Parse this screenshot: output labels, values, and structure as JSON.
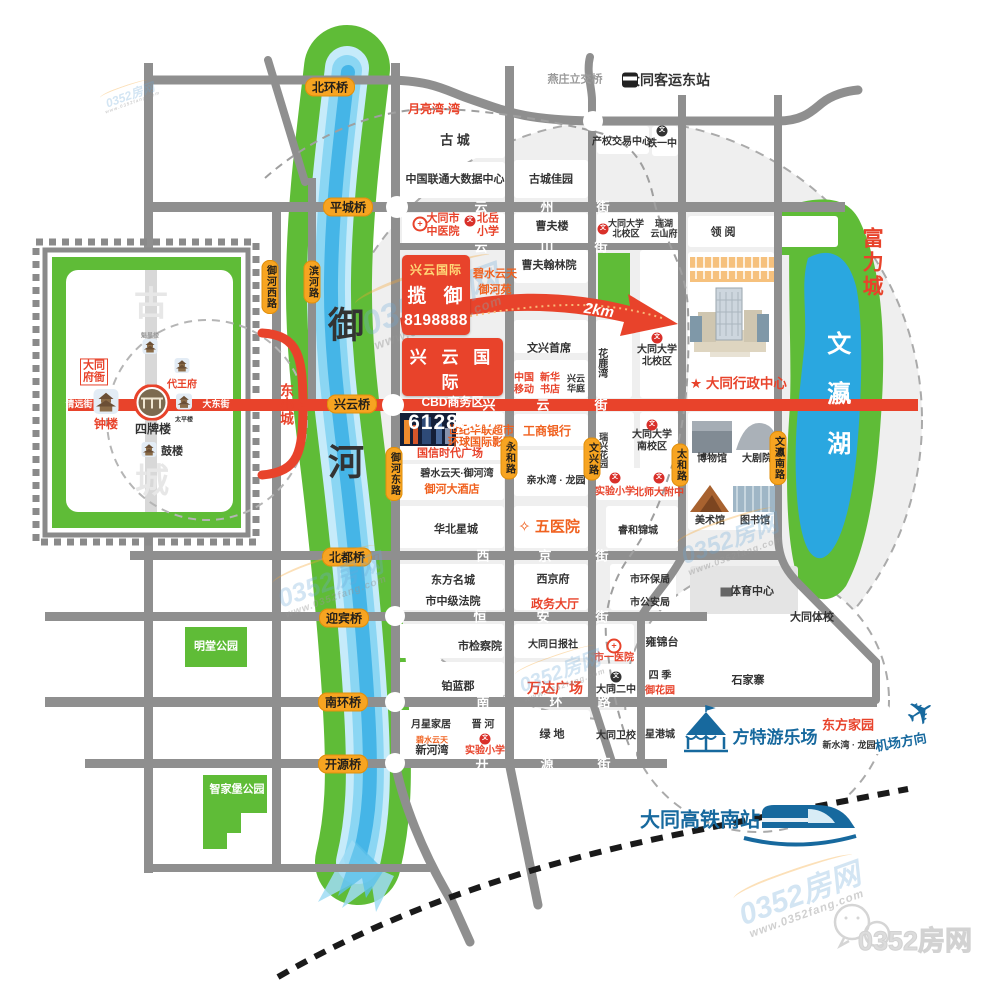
{
  "branding": {
    "site": "0352房网",
    "url": "www.0352fang.com",
    "wechat_label": "0352房网"
  },
  "project": {
    "box1": {
      "brand": "兴云国际",
      "name": "揽 御",
      "phone": "8198888"
    },
    "box1_note": {
      "line1": "碧水云天",
      "line2": "御河苑"
    },
    "box2": {
      "brand": "兴 云 国 际",
      "name": "CBD商务区",
      "phone": "6128888"
    },
    "distance": "2km",
    "admin_center": "★ 大同行政中心"
  },
  "colors": {
    "accent_red": "#e8432b",
    "orange": "#f0611f",
    "pill_orange": "#f7a421",
    "green": "#5fbc37",
    "river_blue": "#45b5e7",
    "lake_blue": "#2aa7e0",
    "road_gray": "#8f8f8f",
    "brand_blue": "#17699e"
  },
  "bridges": [
    {
      "t": "北环桥",
      "x": 330,
      "y": 87
    },
    {
      "t": "平城桥",
      "x": 348,
      "y": 207
    },
    {
      "t": "兴云桥",
      "x": 352,
      "y": 404
    },
    {
      "t": "北都桥",
      "x": 347,
      "y": 557
    },
    {
      "t": "迎宾桥",
      "x": 344,
      "y": 618
    },
    {
      "t": "南环桥",
      "x": 343,
      "y": 702
    },
    {
      "t": "开源桥",
      "x": 343,
      "y": 764
    }
  ],
  "road_pills": [
    {
      "t": "御河西路",
      "x": 270,
      "y": 287
    },
    {
      "t": "滨河路",
      "x": 312,
      "y": 282
    },
    {
      "t": "御河东路",
      "x": 394,
      "y": 474
    },
    {
      "t": "永和路",
      "x": 509,
      "y": 458
    },
    {
      "t": "文兴路",
      "x": 592,
      "y": 459
    },
    {
      "t": "太和路",
      "x": 680,
      "y": 465
    },
    {
      "t": "文瀛南路",
      "x": 778,
      "y": 458
    }
  ],
  "street_chars": [
    {
      "t": "云",
      "x": 481,
      "y": 206
    },
    {
      "t": "州",
      "x": 547,
      "y": 206
    },
    {
      "t": "街",
      "x": 603,
      "y": 206
    },
    {
      "t": "云",
      "x": 481,
      "y": 246
    },
    {
      "t": "山",
      "x": 547,
      "y": 246
    },
    {
      "t": "街",
      "x": 601,
      "y": 246
    },
    {
      "t": "兴",
      "x": 489,
      "y": 404
    },
    {
      "t": "云",
      "x": 543,
      "y": 404
    },
    {
      "t": "街",
      "x": 601,
      "y": 404
    },
    {
      "t": "西",
      "x": 483,
      "y": 555
    },
    {
      "t": "京",
      "x": 545,
      "y": 555
    },
    {
      "t": "街",
      "x": 602,
      "y": 555
    },
    {
      "t": "恒",
      "x": 480,
      "y": 616
    },
    {
      "t": "安",
      "x": 543,
      "y": 616
    },
    {
      "t": "街",
      "x": 602,
      "y": 616
    },
    {
      "t": "南",
      "x": 483,
      "y": 701
    },
    {
      "t": "环",
      "x": 556,
      "y": 701
    },
    {
      "t": "路",
      "x": 604,
      "y": 701
    },
    {
      "t": "开",
      "x": 482,
      "y": 763
    },
    {
      "t": "源",
      "x": 547,
      "y": 763
    },
    {
      "t": "街",
      "x": 604,
      "y": 763
    }
  ],
  "labels": [
    {
      "t": "月亮湾·湾",
      "x": 434,
      "y": 110,
      "c": "r",
      "s": 12
    },
    {
      "t": "燕庄立交桥",
      "x": 575,
      "y": 80,
      "c": "g",
      "s": 11
    },
    {
      "t": "大同客运东站",
      "x": 668,
      "y": 80,
      "c": "k",
      "s": 14
    },
    {
      "t": "古 城",
      "x": 455,
      "y": 141,
      "c": "k",
      "s": 13
    },
    {
      "t": "中国联通大数据中心",
      "x": 455,
      "y": 180,
      "c": "k",
      "s": 11
    },
    {
      "t": "古城佳园",
      "x": 551,
      "y": 180,
      "c": "k",
      "s": 11
    },
    {
      "t": "产权交易中心",
      "x": 622,
      "y": 142,
      "c": "k",
      "s": 10
    },
    {
      "t": "铁一中",
      "x": 662,
      "y": 144,
      "c": "k",
      "s": 10
    },
    {
      "t": "大同市\n中医院",
      "x": 443,
      "y": 225,
      "c": "r",
      "s": 11
    },
    {
      "t": "北岳\n小学",
      "x": 488,
      "y": 225,
      "c": "r",
      "s": 11
    },
    {
      "t": "曹夫楼",
      "x": 552,
      "y": 227,
      "c": "k",
      "s": 11
    },
    {
      "t": "大同大学\n北校区",
      "x": 626,
      "y": 229,
      "c": "k",
      "s": 9
    },
    {
      "t": "瑞湖\n云山府",
      "x": 664,
      "y": 229,
      "c": "k",
      "s": 9
    },
    {
      "t": "领 阅",
      "x": 723,
      "y": 233,
      "c": "k",
      "s": 11
    },
    {
      "t": "富力城",
      "x": 871,
      "y": 263,
      "c": "r",
      "s": 21,
      "v": 1,
      "ls": 3
    },
    {
      "t": "曹夫翰林院",
      "x": 549,
      "y": 266,
      "c": "k",
      "s": 11
    },
    {
      "t": "文兴首席",
      "x": 549,
      "y": 349,
      "c": "k",
      "s": 11
    },
    {
      "t": "中国\n移动",
      "x": 524,
      "y": 384,
      "c": "r",
      "s": 10
    },
    {
      "t": "新华\n书店",
      "x": 550,
      "y": 384,
      "c": "r",
      "s": 10
    },
    {
      "t": "兴云\n华庭",
      "x": 576,
      "y": 384,
      "c": "k",
      "s": 9
    },
    {
      "t": "花鹿湾",
      "x": 601,
      "y": 363,
      "c": "k",
      "s": 10,
      "v": 1
    },
    {
      "t": "大同大学\n北校区",
      "x": 657,
      "y": 356,
      "c": "k",
      "s": 10
    },
    {
      "t": "文瀛湖",
      "x": 836,
      "y": 406,
      "c": "w",
      "s": 24,
      "v": 1,
      "ls": 26
    },
    {
      "t": "东小城",
      "x": 287,
      "y": 404,
      "c": "r",
      "s": 14,
      "v": 1
    },
    {
      "t": "御",
      "x": 346,
      "y": 325,
      "c": "k",
      "s": 36
    },
    {
      "t": "河",
      "x": 346,
      "y": 462,
      "c": "k",
      "s": 36
    },
    {
      "t": "国信时代广场",
      "x": 450,
      "y": 454,
      "c": "r",
      "s": 11
    },
    {
      "t": "世纪华联超市",
      "x": 481,
      "y": 431,
      "c": "o",
      "s": 11
    },
    {
      "t": "环球国际影院",
      "x": 481,
      "y": 443,
      "c": "o",
      "s": 11
    },
    {
      "t": "工商银行",
      "x": 547,
      "y": 432,
      "c": "o",
      "s": 12
    },
    {
      "t": "瑞兴花园",
      "x": 603,
      "y": 450,
      "c": "k",
      "s": 9,
      "v": 1
    },
    {
      "t": "大同大学\n南校区",
      "x": 652,
      "y": 441,
      "c": "k",
      "s": 10
    },
    {
      "t": "碧水云天·御河湾",
      "x": 457,
      "y": 474,
      "c": "k",
      "s": 10
    },
    {
      "t": "御河大酒店",
      "x": 452,
      "y": 490,
      "c": "o",
      "s": 11
    },
    {
      "t": "亲水湾 · 龙园",
      "x": 556,
      "y": 481,
      "c": "k",
      "s": 10
    },
    {
      "t": "实验小学",
      "x": 615,
      "y": 492,
      "c": "r",
      "s": 10
    },
    {
      "t": "北师大附中",
      "x": 659,
      "y": 493,
      "c": "r",
      "s": 10
    },
    {
      "t": "华北星城",
      "x": 456,
      "y": 530,
      "c": "k",
      "s": 11
    },
    {
      "t": "✧ 五医院",
      "x": 549,
      "y": 527,
      "c": "o",
      "s": 15
    },
    {
      "t": "睿和锦城",
      "x": 638,
      "y": 531,
      "c": "k",
      "s": 10
    },
    {
      "t": "博物馆",
      "x": 712,
      "y": 459,
      "c": "k",
      "s": 10
    },
    {
      "t": "大剧院",
      "x": 757,
      "y": 459,
      "c": "k",
      "s": 10
    },
    {
      "t": "美术馆",
      "x": 710,
      "y": 521,
      "c": "k",
      "s": 10
    },
    {
      "t": "图书馆",
      "x": 755,
      "y": 521,
      "c": "k",
      "s": 10
    },
    {
      "t": "东方名城",
      "x": 453,
      "y": 581,
      "c": "k",
      "s": 11
    },
    {
      "t": "西京府",
      "x": 553,
      "y": 580,
      "c": "k",
      "s": 11
    },
    {
      "t": "市环保局",
      "x": 650,
      "y": 580,
      "c": "k",
      "s": 10
    },
    {
      "t": "体育中心",
      "x": 752,
      "y": 592,
      "c": "k",
      "s": 11
    },
    {
      "t": "市中级法院",
      "x": 453,
      "y": 602,
      "c": "k",
      "s": 11
    },
    {
      "t": "政务大厅",
      "x": 555,
      "y": 605,
      "c": "r",
      "s": 12
    },
    {
      "t": "市公安局",
      "x": 650,
      "y": 603,
      "c": "k",
      "s": 10
    },
    {
      "t": "大同体校",
      "x": 812,
      "y": 618,
      "c": "k",
      "s": 11
    },
    {
      "t": "市检察院",
      "x": 480,
      "y": 647,
      "c": "k",
      "s": 11
    },
    {
      "t": "大同日报社",
      "x": 553,
      "y": 645,
      "c": "k",
      "s": 10
    },
    {
      "t": "市一医院",
      "x": 614,
      "y": 658,
      "c": "r",
      "s": 10
    },
    {
      "t": "雍锦台",
      "x": 662,
      "y": 643,
      "c": "k",
      "s": 11
    },
    {
      "t": "铂蓝郡",
      "x": 458,
      "y": 687,
      "c": "k",
      "s": 11
    },
    {
      "t": "万达广场",
      "x": 555,
      "y": 688,
      "c": "r",
      "s": 14
    },
    {
      "t": "大同二中",
      "x": 616,
      "y": 690,
      "c": "k",
      "s": 10
    },
    {
      "t": "四 季",
      "x": 660,
      "y": 676,
      "c": "k",
      "s": 10
    },
    {
      "t": "御花园",
      "x": 660,
      "y": 691,
      "c": "r",
      "s": 10
    },
    {
      "t": "石家寨",
      "x": 748,
      "y": 681,
      "c": "k",
      "s": 11
    },
    {
      "t": "月星家居",
      "x": 431,
      "y": 725,
      "c": "k",
      "s": 10
    },
    {
      "t": "晋 河",
      "x": 483,
      "y": 725,
      "c": "k",
      "s": 10
    },
    {
      "t": "碧水云天",
      "x": 432,
      "y": 740,
      "c": "o",
      "s": 8
    },
    {
      "t": "新河湾",
      "x": 432,
      "y": 751,
      "c": "k",
      "s": 11
    },
    {
      "t": "实验小学",
      "x": 485,
      "y": 751,
      "c": "r",
      "s": 10
    },
    {
      "t": "绿 地",
      "x": 552,
      "y": 735,
      "c": "k",
      "s": 11
    },
    {
      "t": "大同卫校",
      "x": 616,
      "y": 736,
      "c": "k",
      "s": 10
    },
    {
      "t": "星港城",
      "x": 660,
      "y": 735,
      "c": "k",
      "s": 10
    },
    {
      "t": "方特游乐场",
      "x": 775,
      "y": 738,
      "c": "b",
      "s": 17
    },
    {
      "t": "东方家园",
      "x": 848,
      "y": 726,
      "c": "r",
      "s": 13
    },
    {
      "t": "新水湾 · 龙园",
      "x": 849,
      "y": 745,
      "c": "k",
      "s": 9
    },
    {
      "t": "机场方向",
      "x": 901,
      "y": 743,
      "c": "b",
      "s": 13,
      "r": -10
    },
    {
      "t": "大同高铁南站",
      "x": 700,
      "y": 821,
      "c": "b",
      "s": 20
    },
    {
      "t": "明堂公园",
      "x": 216,
      "y": 647,
      "c": "w",
      "s": 11
    },
    {
      "t": "智家堡公园",
      "x": 237,
      "y": 790,
      "c": "w",
      "s": 11
    },
    {
      "t": "魁星楼",
      "x": 150,
      "y": 337,
      "c": "g",
      "s": 6
    },
    {
      "t": "代王府",
      "x": 182,
      "y": 385,
      "c": "r",
      "s": 10
    },
    {
      "t": "大同\n府衙",
      "x": 94,
      "y": 372,
      "c": "rbox",
      "s": 11
    },
    {
      "t": "清远街",
      "x": 79,
      "y": 404,
      "c": "w",
      "s": 9
    },
    {
      "t": "大东街",
      "x": 216,
      "y": 404,
      "c": "w",
      "s": 9
    },
    {
      "t": "钟楼",
      "x": 106,
      "y": 425,
      "c": "r",
      "s": 12
    },
    {
      "t": "四牌楼",
      "x": 153,
      "y": 430,
      "c": "k",
      "s": 12
    },
    {
      "t": "太平楼",
      "x": 184,
      "y": 421,
      "c": "k",
      "s": 6
    },
    {
      "t": "鼓楼",
      "x": 172,
      "y": 452,
      "c": "k",
      "s": 11
    },
    {
      "t": "古",
      "x": 151,
      "y": 305,
      "c": "wall",
      "s": 34
    },
    {
      "t": "城",
      "x": 152,
      "y": 482,
      "c": "wall",
      "s": 34
    }
  ],
  "icons": [
    {
      "k": "hosp",
      "x": 420,
      "y": 224
    },
    {
      "k": "schR",
      "x": 470,
      "y": 221
    },
    {
      "k": "schK",
      "x": 662,
      "y": 131
    },
    {
      "k": "schR",
      "x": 603,
      "y": 229
    },
    {
      "k": "schR",
      "x": 657,
      "y": 338
    },
    {
      "k": "schR",
      "x": 652,
      "y": 425
    },
    {
      "k": "schR",
      "x": 615,
      "y": 478
    },
    {
      "k": "schR",
      "x": 659,
      "y": 478
    },
    {
      "k": "schR",
      "x": 485,
      "y": 739
    },
    {
      "k": "hosp",
      "x": 614,
      "y": 646
    },
    {
      "k": "schK",
      "x": 616,
      "y": 677
    },
    {
      "k": "bld",
      "x": 726,
      "y": 592
    },
    {
      "k": "bus",
      "x": 630,
      "y": 80
    },
    {
      "k": "plane",
      "x": 921,
      "y": 713
    },
    {
      "k": "tower",
      "x": 150,
      "y": 349,
      "w": 15,
      "h": 17
    },
    {
      "k": "tower",
      "x": 182,
      "y": 368,
      "w": 17,
      "h": 15
    },
    {
      "k": "tower",
      "x": 106,
      "y": 404,
      "w": 25,
      "h": 25
    },
    {
      "k": "sipailou",
      "x": 152,
      "y": 405
    },
    {
      "k": "tower",
      "x": 184,
      "y": 404,
      "w": 16,
      "h": 16
    },
    {
      "k": "tower",
      "x": 149,
      "y": 452,
      "w": 15,
      "h": 17
    }
  ],
  "watermarks": [
    {
      "x": 130,
      "y": 95,
      "s": 12
    },
    {
      "x": 430,
      "y": 300,
      "s": 34
    },
    {
      "x": 330,
      "y": 580,
      "s": 26
    },
    {
      "x": 730,
      "y": 540,
      "s": 24
    },
    {
      "x": 560,
      "y": 672,
      "s": 20
    },
    {
      "x": 800,
      "y": 895,
      "s": 30
    }
  ]
}
